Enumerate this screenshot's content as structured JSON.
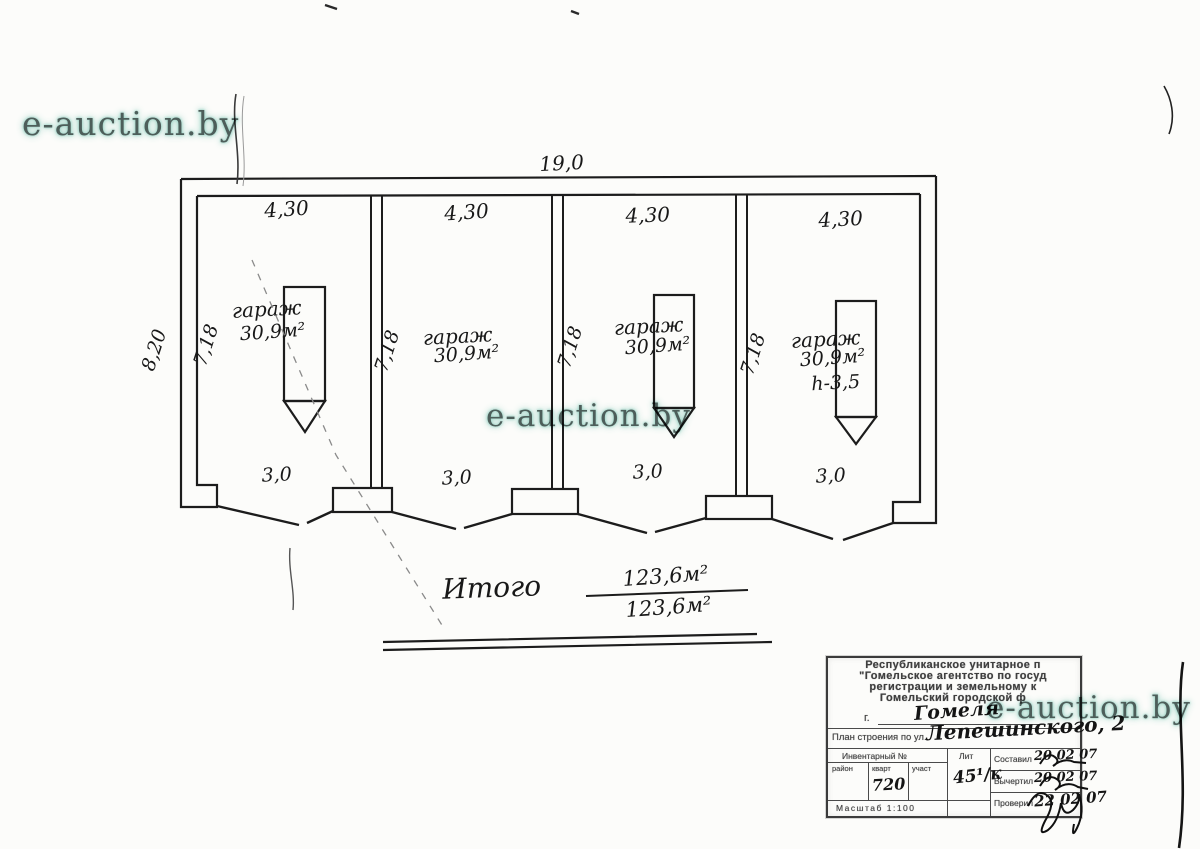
{
  "watermark": {
    "text": "e-auction.by"
  },
  "plan": {
    "overall_width": "19,0",
    "overall_depth": "8,20",
    "garages": [
      {
        "label": "гараж",
        "area": "30,9м²",
        "width": "4,30",
        "depth": "7,18",
        "gate_width": "3,0"
      },
      {
        "label": "гараж",
        "area": "30,9м²",
        "width": "4,30",
        "depth": "7,18",
        "gate_width": "3,0"
      },
      {
        "label": "гараж",
        "area": "30,9м²",
        "width": "4,30",
        "depth": "7,18",
        "gate_width": "3,0"
      },
      {
        "label": "гараж",
        "area": "30,9м²",
        "width": "4,30",
        "depth": "7,18",
        "gate_width": "3,0",
        "height": "h-3,5"
      }
    ],
    "total": {
      "label": "Итого",
      "numerator": "123,6м²",
      "denominator": "123,6м²"
    }
  },
  "title_block": {
    "org_lines": [
      "Республиканское унитарное п",
      "\"Гомельское агентство по госуд",
      "регистрации и земельному к",
      "Гомельский городской ф"
    ],
    "city_prefix": "г.",
    "city_value": "Гомеля",
    "address_label": "План строения по ул.",
    "address_value": "Лепешинского, 2",
    "inventory_label": "Инвентарный №",
    "cols": {
      "rayon": "район",
      "kvart": "кварт",
      "uchast": "участ"
    },
    "kvart_value": "720",
    "lit_label": "Лит",
    "lit_value": "45¹/к",
    "rows": {
      "sostavil": {
        "label": "Составил",
        "date": "20 02 07"
      },
      "vychertil": {
        "label": "Вычертил",
        "date": "20 02 07"
      },
      "proveril": {
        "label": "Проверил",
        "date": "22 02 07"
      }
    },
    "scale": "Масштаб 1:100"
  }
}
